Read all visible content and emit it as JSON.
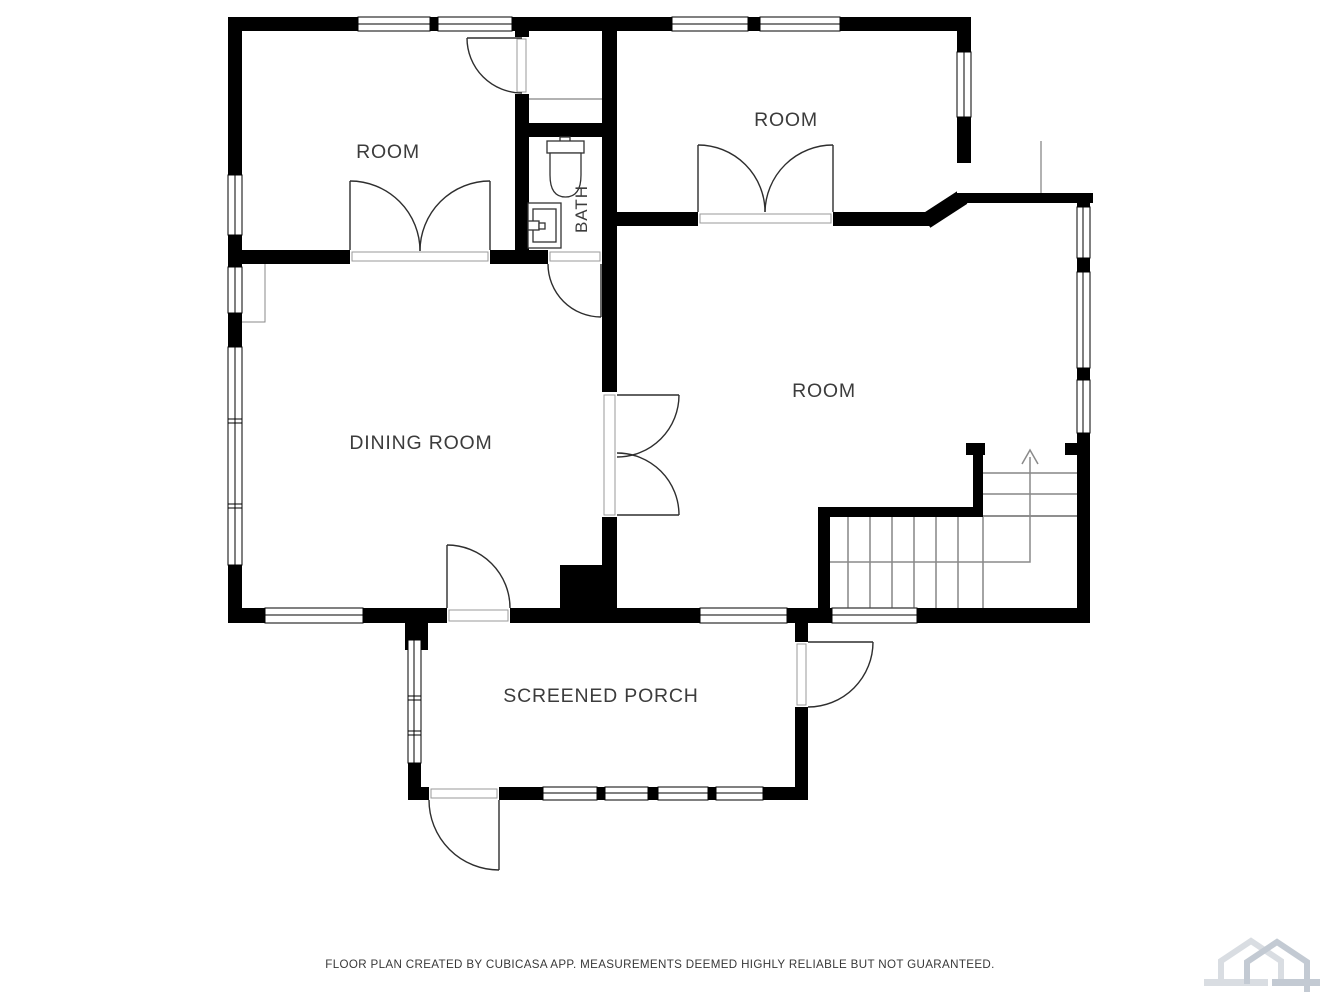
{
  "floorplan": {
    "wall_color": "#000000",
    "label_color": "#3c3c3c",
    "rooms": [
      {
        "id": "room-top-left",
        "label": "ROOM"
      },
      {
        "id": "room-top-right",
        "label": "ROOM"
      },
      {
        "id": "bath",
        "label": "BATH"
      },
      {
        "id": "dining-room",
        "label": "DINING ROOM"
      },
      {
        "id": "room-main",
        "label": "ROOM"
      },
      {
        "id": "screened-porch",
        "label": "SCREENED PORCH"
      }
    ],
    "features": [
      {
        "id": "stairs",
        "icon": "stairs-up-arrow-icon"
      },
      {
        "id": "toilet",
        "icon": "toilet-icon"
      },
      {
        "id": "sink",
        "icon": "sink-icon"
      }
    ]
  },
  "footer": {
    "disclaimer": "FLOOR PLAN CREATED BY CUBICASA APP. MEASUREMENTS DEEMED HIGHLY RELIABLE BUT NOT GUARANTEED."
  },
  "branding": {
    "logo_name": "cubicasa-logo",
    "logo_color_light": "#d9dde2",
    "logo_color_dark": "#c3cad3"
  }
}
